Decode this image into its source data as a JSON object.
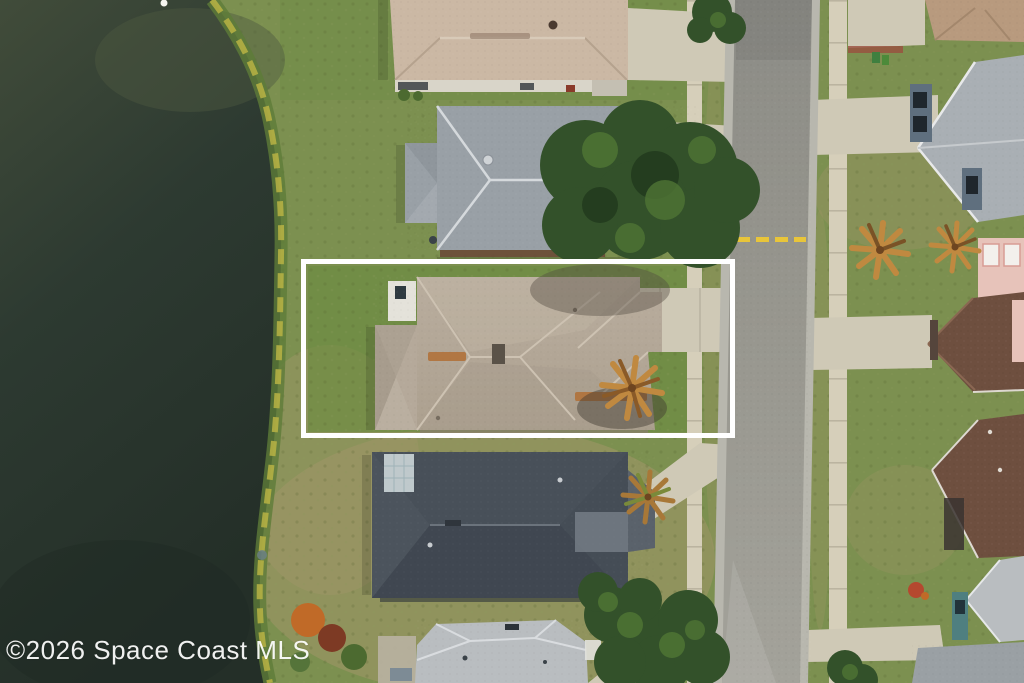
{
  "watermark": {
    "text": "©2026 Space Coast MLS"
  },
  "annotation": {
    "label": "property-boundary",
    "shape": "rectangle",
    "stroke_color": "#ffffff"
  },
  "scene": {
    "setting": "aerial drone view of a lakefront residential street",
    "elements": [
      "pond",
      "shoreline",
      "lawns",
      "single-family-houses",
      "street",
      "sidewalks",
      "driveways",
      "oak-tree-canopy",
      "palm-trees",
      "white-property-boundary-outline"
    ]
  },
  "palette": {
    "water": "#2d3a31",
    "water-shallow": "#4e5840",
    "shore-fringe": "#b8b344",
    "shore-grass": "#5e7c38",
    "grass": "#7c9050",
    "grass-bright": "#6b8c41",
    "grass-dry": "#a09668",
    "road": "#98978f",
    "curb": "#b8b7ae",
    "sidewalk": "#d6cfba",
    "driveway": "#cfc9b6",
    "roof-subject": "#b5a99a",
    "roof-house-a": "#cbb8a4",
    "roof-house-b": "#99a0a6",
    "roof-house-d": "#454d56",
    "roof-house-e": "#b9bdc0",
    "roof-right-gray": "#a9afb4",
    "roof-right-brown": "#6e4f3f",
    "wall-pink": "#e7c3ba",
    "wall-blue": "#5f6f7e",
    "wall-teal": "#4f7f80",
    "tree": "#33512a",
    "tree-light": "#4f7434",
    "palm": "#c08940",
    "outline": "#ffffff",
    "road-marking": "#e8c53a",
    "watermark-text": "#ffffff"
  }
}
